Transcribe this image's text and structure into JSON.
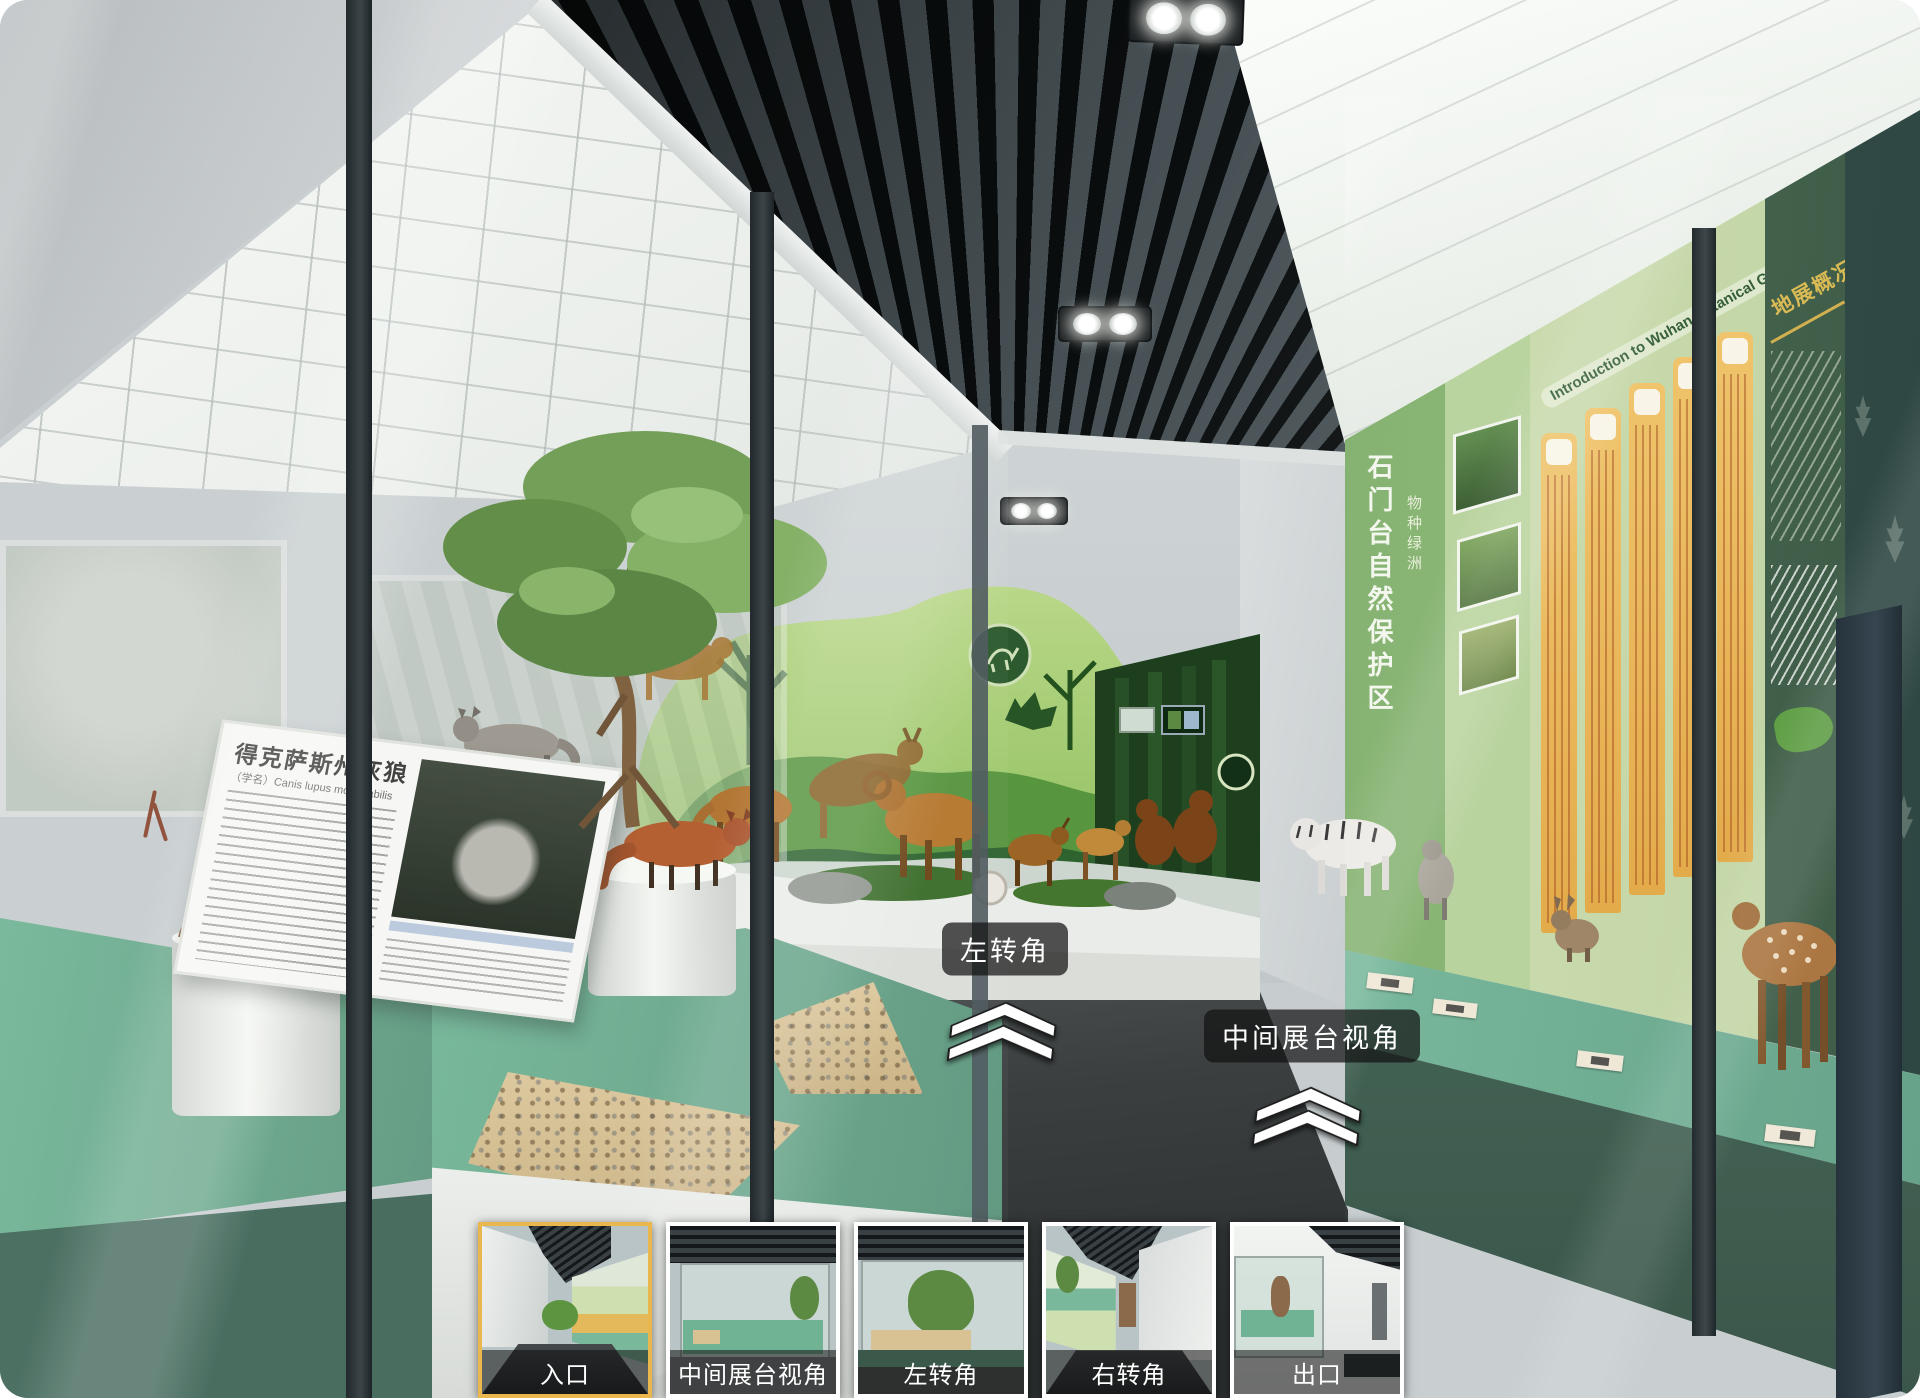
{
  "viewer": {
    "type": "panorama-virtual-tour",
    "hotspots": [
      {
        "label": "左转角"
      },
      {
        "label": "中间展台视角"
      }
    ],
    "thumbnails": [
      {
        "label": "入口",
        "active": true
      },
      {
        "label": "中间展台视角",
        "active": false
      },
      {
        "label": "左转角",
        "active": false
      },
      {
        "label": "右转角",
        "active": false
      },
      {
        "label": "出口",
        "active": false
      }
    ]
  },
  "scene": {
    "left_case": {
      "board_title": "得克萨斯州灰狼",
      "board_latin": "（学名）Canis lupus monstrabilis"
    },
    "right_case": {
      "reserve_title": "石门台自然保护区",
      "reserve_subtitle": "物种绿洲",
      "garden_panel_title": "Introduction to Wuhan Botanical Garden",
      "overview_panel_title": "地展概况"
    }
  },
  "colors": {
    "active_thumb_border": "#EAB64E",
    "thumb_border": "#FFFFFF",
    "platform_teal": "#6FB394",
    "hotspot_bg": "rgba(18,18,18,0.72)",
    "card_yellow": "#E8B453",
    "mural_green": "#8DBF5D",
    "floor_dark": "#3B3F40"
  }
}
